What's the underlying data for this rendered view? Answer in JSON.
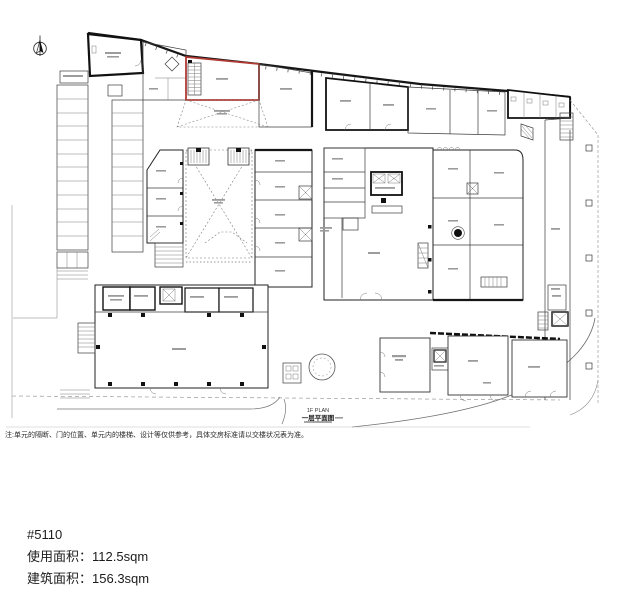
{
  "plan": {
    "title_en": "1F PLAN",
    "title_zh": "一层平面图",
    "highlight_color": "#b03a33"
  },
  "footnote": "注:单元的隔断、门的位置、单元内的楼梯、设计等仅供参考，具体交房标准请以交楼状况表为准。",
  "unit_info": {
    "unit_number": "#5110",
    "usable_area_label": "使用面积：",
    "usable_area_value": "112.5sqm",
    "gross_area_label": "建筑面积：",
    "gross_area_value": "156.3sqm"
  }
}
